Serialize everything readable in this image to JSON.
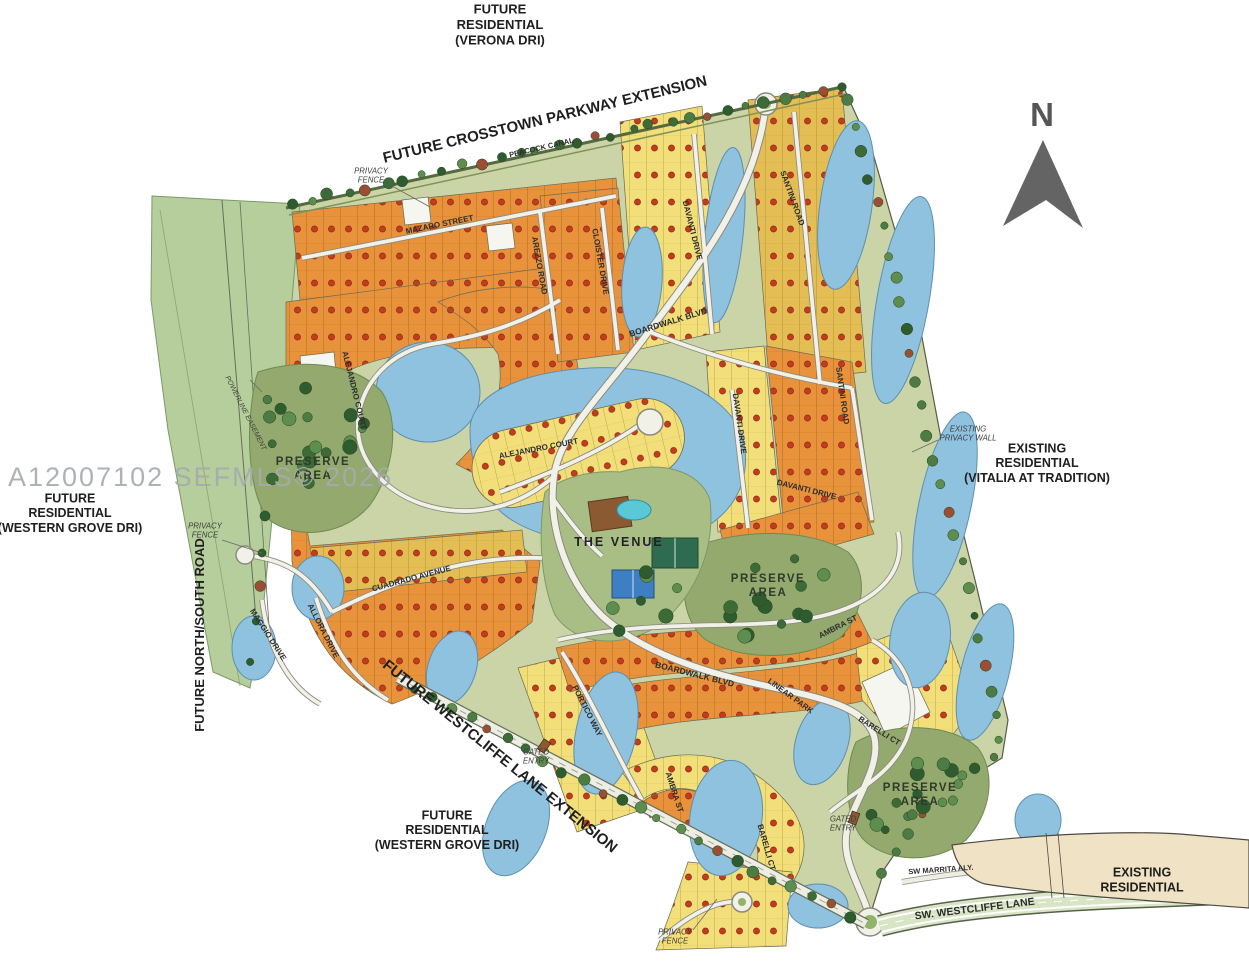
{
  "watermark": {
    "text": "A12007102 SEFMLS© 2026",
    "x": 8,
    "y": 486,
    "size": 27
  },
  "compass": {
    "letter": "N",
    "x": 1042,
    "y": 126,
    "size": 33
  },
  "colors": {
    "orange_lot": "#E8923C",
    "yellow_lot": "#F2DF7A",
    "golden_lot": "#E4BE55",
    "lake": "#8FC2DF",
    "preserve": "#93A96E",
    "land_base": "#CBD4A6",
    "road": "#F2F1E8",
    "existing_residential_area": "#F0E2C4",
    "boundary_green": "#B5CE9C",
    "sold_dot": "#C43B1E",
    "watermark_gray": "#A6AAB0"
  },
  "map": {
    "labels": [
      {
        "name": "label-future-residential-verona",
        "kind": "region",
        "lines": [
          "FUTURE",
          "RESIDENTIAL",
          "(VERONA DRI)"
        ],
        "x": 500,
        "y": 29,
        "rot": 0,
        "size": 13
      },
      {
        "name": "label-future-crosstown-parkway",
        "kind": "region",
        "lines": [
          "FUTURE  CROSSTOWN  PARKWAY  EXTENSION"
        ],
        "x": 546,
        "y": 124,
        "rot": -13.5,
        "size": 15
      },
      {
        "name": "label-existing-residential-vitalia",
        "kind": "region",
        "lines": [
          "EXISTING",
          "RESIDENTIAL",
          "(VITALIA AT TRADITION)"
        ],
        "x": 1037,
        "y": 467,
        "rot": 0,
        "size": 12.5
      },
      {
        "name": "label-future-residential-western-grove-left",
        "kind": "region",
        "lines": [
          "FUTURE",
          "RESIDENTIAL",
          "(WESTERN GROVE DRI)"
        ],
        "x": 70,
        "y": 517,
        "rot": 0,
        "size": 12.5
      },
      {
        "name": "label-future-north-south-road",
        "kind": "region",
        "lines": [
          "FUTURE  NORTH/SOUTH  ROAD"
        ],
        "x": 204,
        "y": 635,
        "rot": -90,
        "size": 13
      },
      {
        "name": "label-future-westcliffe-lane-extension",
        "kind": "region",
        "lines": [
          "FUTURE WESTCLIFFE LANE EXTENSION"
        ],
        "x": 497,
        "y": 760,
        "rot": 39,
        "size": 15
      },
      {
        "name": "label-future-residential-western-grove-bottom",
        "kind": "region",
        "lines": [
          "FUTURE",
          "RESIDENTIAL",
          "(WESTERN GROVE DRI)"
        ],
        "x": 447,
        "y": 834,
        "rot": 0,
        "size": 12.5
      },
      {
        "name": "label-existing-residential-bottom-right",
        "kind": "region",
        "lines": [
          "EXISTING",
          "RESIDENTIAL"
        ],
        "x": 1142,
        "y": 884,
        "rot": 0,
        "size": 12.5
      },
      {
        "name": "label-peacock-canal",
        "kind": "street",
        "lines": [
          "PEACOCK  CANAL"
        ],
        "x": 542,
        "y": 150,
        "rot": -13,
        "size": 7.5
      },
      {
        "name": "label-mazaro-street",
        "kind": "street",
        "lines": [
          "MAZARO STREET"
        ],
        "x": 440,
        "y": 227,
        "rot": -11.5,
        "size": 8
      },
      {
        "name": "label-arezzo-road",
        "kind": "street",
        "lines": [
          "AREZZO ROAD"
        ],
        "x": 537,
        "y": 266,
        "rot": 80,
        "size": 8
      },
      {
        "name": "label-cloister-drive",
        "kind": "street",
        "lines": [
          "CLOISTER DRIVE"
        ],
        "x": 598,
        "y": 262,
        "rot": 80,
        "size": 8
      },
      {
        "name": "label-davanti-drive-1",
        "kind": "street",
        "lines": [
          "DAVANTI DRIVE"
        ],
        "x": 690,
        "y": 231,
        "rot": 76,
        "size": 8
      },
      {
        "name": "label-santini-road-1",
        "kind": "street",
        "lines": [
          "SANTINI ROAD"
        ],
        "x": 790,
        "y": 199,
        "rot": 70,
        "size": 8
      },
      {
        "name": "label-boardwalk-blvd-1",
        "kind": "street",
        "lines": [
          "BOARDWALK BLVD"
        ],
        "x": 669,
        "y": 325,
        "rot": -17,
        "size": 8.5
      },
      {
        "name": "label-santini-road-2",
        "kind": "street",
        "lines": [
          "SANTINI ROAD"
        ],
        "x": 840,
        "y": 396,
        "rot": 82,
        "size": 8
      },
      {
        "name": "label-davanti-drive-2",
        "kind": "street",
        "lines": [
          "DAVANTI DRIVE"
        ],
        "x": 737,
        "y": 424,
        "rot": 82,
        "size": 8
      },
      {
        "name": "label-davanti-drive-3",
        "kind": "street",
        "lines": [
          "DAVANTI DRIVE"
        ],
        "x": 806,
        "y": 492,
        "rot": 14,
        "size": 8
      },
      {
        "name": "label-alejandro-court-1",
        "kind": "street",
        "lines": [
          "ALEJANDRO COURT"
        ],
        "x": 352,
        "y": 391,
        "rot": 76,
        "size": 8
      },
      {
        "name": "label-alejandro-court-2",
        "kind": "street",
        "lines": [
          "ALEJANDRO COURT"
        ],
        "x": 539,
        "y": 451,
        "rot": -11,
        "size": 8
      },
      {
        "name": "label-cuadrado-avenue",
        "kind": "street",
        "lines": [
          "CUADRADO AVENUE"
        ],
        "x": 412,
        "y": 581,
        "rot": -15,
        "size": 8
      },
      {
        "name": "label-maggio-drive",
        "kind": "street",
        "lines": [
          "MAGGIO DRIVE"
        ],
        "x": 266,
        "y": 636,
        "rot": 57,
        "size": 8
      },
      {
        "name": "label-allora-drive",
        "kind": "street",
        "lines": [
          "ALLORA DRIVE"
        ],
        "x": 321,
        "y": 632,
        "rot": 63,
        "size": 8
      },
      {
        "name": "label-ambra-st-1",
        "kind": "street",
        "lines": [
          "AMBRA ST"
        ],
        "x": 839,
        "y": 629,
        "rot": -27,
        "size": 8
      },
      {
        "name": "label-linear-park",
        "kind": "street",
        "lines": [
          "LINEAR  PARK"
        ],
        "x": 789,
        "y": 698,
        "rot": 36,
        "size": 8
      },
      {
        "name": "label-boardwalk-blvd-2",
        "kind": "street",
        "lines": [
          "BOARDWALK BLVD"
        ],
        "x": 694,
        "y": 677,
        "rot": 14,
        "size": 8.5
      },
      {
        "name": "label-portico-way",
        "kind": "street",
        "lines": [
          "PORTICO WAY"
        ],
        "x": 585,
        "y": 712,
        "rot": 63,
        "size": 8
      },
      {
        "name": "label-barelli-ct-1",
        "kind": "street",
        "lines": [
          "BARELLI CT"
        ],
        "x": 878,
        "y": 733,
        "rot": 32,
        "size": 8
      },
      {
        "name": "label-ambra-st-2",
        "kind": "street",
        "lines": [
          "AMBRA ST"
        ],
        "x": 672,
        "y": 793,
        "rot": 72,
        "size": 8
      },
      {
        "name": "label-barelli-ct-2",
        "kind": "street",
        "lines": [
          "BARELLI CT"
        ],
        "x": 764,
        "y": 848,
        "rot": 74,
        "size": 8
      },
      {
        "name": "label-sw-marrita-aly",
        "kind": "street",
        "lines": [
          "SW MARRITA ALY."
        ],
        "x": 941,
        "y": 872,
        "rot": -4,
        "size": 7.5
      },
      {
        "name": "label-sw-westcliffe-lane",
        "kind": "street",
        "lines": [
          "SW. WESTCLIFFE  LANE"
        ],
        "x": 975,
        "y": 912,
        "rot": -7,
        "size": 10.5
      },
      {
        "name": "label-the-venue",
        "kind": "venue",
        "lines": [
          "THE VENUE"
        ],
        "x": 619,
        "y": 546,
        "rot": 0,
        "size": 12.5
      },
      {
        "name": "label-privacy-fence-top",
        "kind": "annotation",
        "lines": [
          "PRIVACY",
          "FENCE"
        ],
        "x": 371,
        "y": 178,
        "rot": 0,
        "size": 7.8
      },
      {
        "name": "label-privacy-fence-left",
        "kind": "annotation",
        "lines": [
          "PRIVACY",
          "FENCE"
        ],
        "x": 205,
        "y": 533,
        "rot": 0,
        "size": 7.8
      },
      {
        "name": "label-existing-privacy-wall",
        "kind": "annotation",
        "lines": [
          "EXISTING",
          "PRIVACY WALL"
        ],
        "x": 968,
        "y": 436,
        "rot": 0,
        "size": 7.8
      },
      {
        "name": "label-privacy-fence-bottom",
        "kind": "annotation",
        "lines": [
          "PRIVACY",
          "FENCE"
        ],
        "x": 675,
        "y": 939,
        "rot": 0,
        "size": 7.8
      },
      {
        "name": "label-gated-entry-west",
        "kind": "annotation",
        "lines": [
          "GATED",
          "ENTRY"
        ],
        "x": 536,
        "y": 759,
        "rot": 0,
        "size": 7.8
      },
      {
        "name": "label-gated-entry-east",
        "kind": "annotation",
        "lines": [
          "GATED",
          "ENTRY"
        ],
        "x": 843,
        "y": 826,
        "rot": 0,
        "size": 7.8
      },
      {
        "name": "label-powerline-easement",
        "kind": "annotation",
        "lines": [
          "POWERLINE EASEMENT"
        ],
        "x": 244,
        "y": 414,
        "rot": 63,
        "size": 7
      },
      {
        "name": "label-preserve-area-west",
        "kind": "area",
        "lines": [
          "PRESERVE",
          "AREA"
        ],
        "x": 313,
        "y": 472,
        "rot": 0,
        "size": 11.5
      },
      {
        "name": "label-preserve-area-center",
        "kind": "area",
        "lines": [
          "PRESERVE",
          "AREA"
        ],
        "x": 768,
        "y": 589,
        "rot": 0,
        "size": 11.5
      },
      {
        "name": "label-preserve-area-southeast",
        "kind": "area",
        "lines": [
          "PRESERVE",
          "AREA"
        ],
        "x": 920,
        "y": 798,
        "rot": 0,
        "size": 11.5
      }
    ]
  }
}
